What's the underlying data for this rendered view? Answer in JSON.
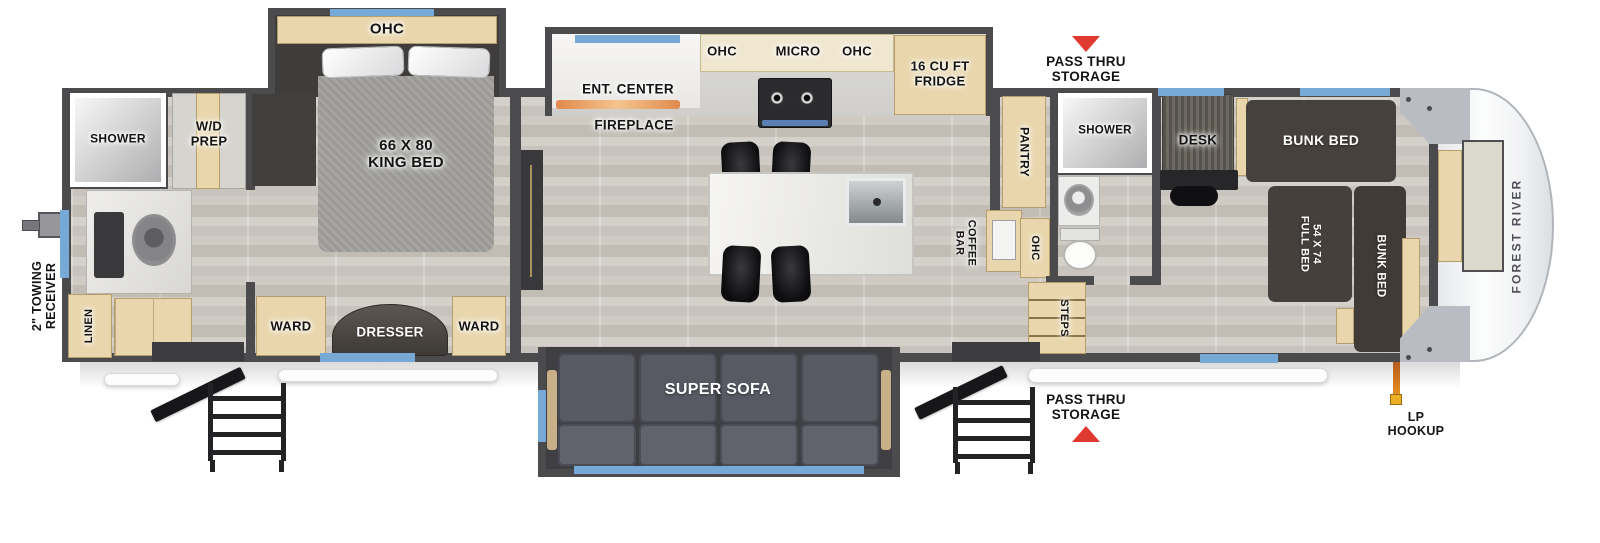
{
  "colors": {
    "wall": "#4b4b4d",
    "floor": "#ccc8c1",
    "cabinet_tan": "#e9d6ac",
    "dark_furniture": "#46413d",
    "sofa": "#575a63",
    "window_accent": "#76a9d6",
    "arrow_red": "#e0392f",
    "lp_orange": "#e8921f",
    "cap_white": "#fcfdfd"
  },
  "brand": {
    "front_cap": "FOREST RIVER"
  },
  "exterior": {
    "towing_receiver": "2\" TOWING RECEIVER",
    "pass_thru_top": "PASS THRU STORAGE",
    "pass_thru_bottom": "PASS THRU STORAGE",
    "lp_hookup": "LP HOOKUP"
  },
  "rear_bath": {
    "shower": "SHOWER",
    "wd_prep": "W/D PREP",
    "linen": "LINEN"
  },
  "bedroom": {
    "ohc": "OHC",
    "king_bed": "66 X 80 KING BED",
    "ward_left": "WARD",
    "dresser": "DRESSER",
    "ward_right": "WARD"
  },
  "kitchen": {
    "ent_center": "ENT. CENTER",
    "fireplace": "FIREPLACE",
    "ohc_left": "OHC",
    "micro": "MICRO",
    "ohc_right": "OHC",
    "fridge": "16 CU FT FRIDGE",
    "pantry": "PANTRY",
    "coffee_bar": "COFFEE BAR"
  },
  "living": {
    "super_sofa": "SUPER SOFA"
  },
  "mid_bath": {
    "shower": "SHOWER",
    "ohc": "OHC",
    "steps": "STEPS"
  },
  "bunk_room": {
    "desk": "DESK",
    "bunk_bed_top": "BUNK BED",
    "full_bed": "54 X 74 FULL BED",
    "bunk_bed_front": "BUNK BED"
  }
}
